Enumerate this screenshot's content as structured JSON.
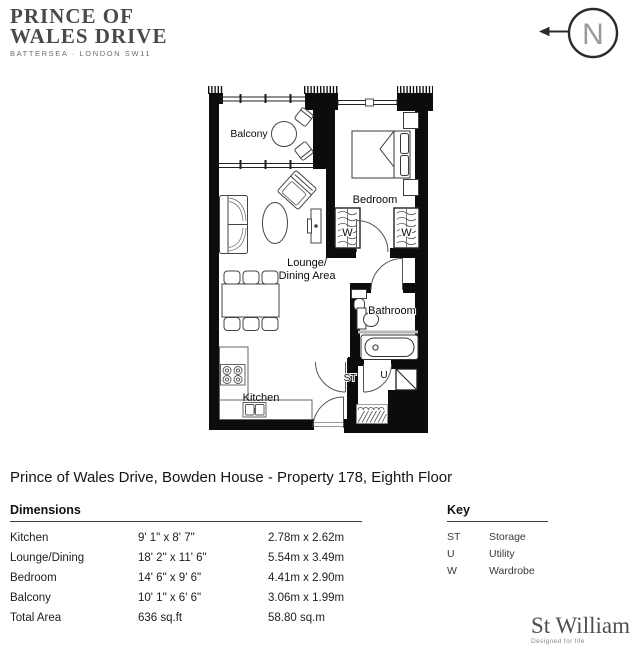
{
  "header": {
    "logo_line1": "PRINCE OF",
    "logo_line2": "WALES DRIVE",
    "logo_subtitle": "BATTERSEA · LONDON SW11"
  },
  "north_label": "N",
  "floorplan": {
    "labels": {
      "balcony": "Balcony",
      "bedroom": "Bedroom",
      "lounge_line1": "Lounge/",
      "lounge_line2": "Dining Area",
      "bathroom": "Bathroom",
      "kitchen": "Kitchen",
      "storage": "ST",
      "utility": "U",
      "wardrobe": "W"
    }
  },
  "title": "Prince of Wales Drive, Bowden House - Property 178, Eighth Floor",
  "dimensions": {
    "heading": "Dimensions",
    "rows": [
      {
        "name": "Kitchen",
        "imperial": "9' 1\" x 8' 7\"",
        "metric": "2.78m x 2.62m"
      },
      {
        "name": "Lounge/Dining",
        "imperial": "18' 2\" x 11' 6\"",
        "metric": "5.54m x 3.49m"
      },
      {
        "name": "Bedroom",
        "imperial": "14' 6\" x 9' 6\"",
        "metric": "4.41m x 2.90m"
      },
      {
        "name": "Balcony",
        "imperial": "10' 1\" x 6' 6\"",
        "metric": "3.06m x 1.99m"
      },
      {
        "name": "Total Area",
        "imperial": "636 sq.ft",
        "metric": "58.80 sq.m"
      }
    ]
  },
  "key": {
    "heading": "Key",
    "items": [
      {
        "code": "ST",
        "label": "Storage"
      },
      {
        "code": "U",
        "label": "Utility"
      },
      {
        "code": "W",
        "label": "Wardrobe"
      }
    ]
  },
  "brand": {
    "name": "St William",
    "tagline": "Designed for life"
  }
}
